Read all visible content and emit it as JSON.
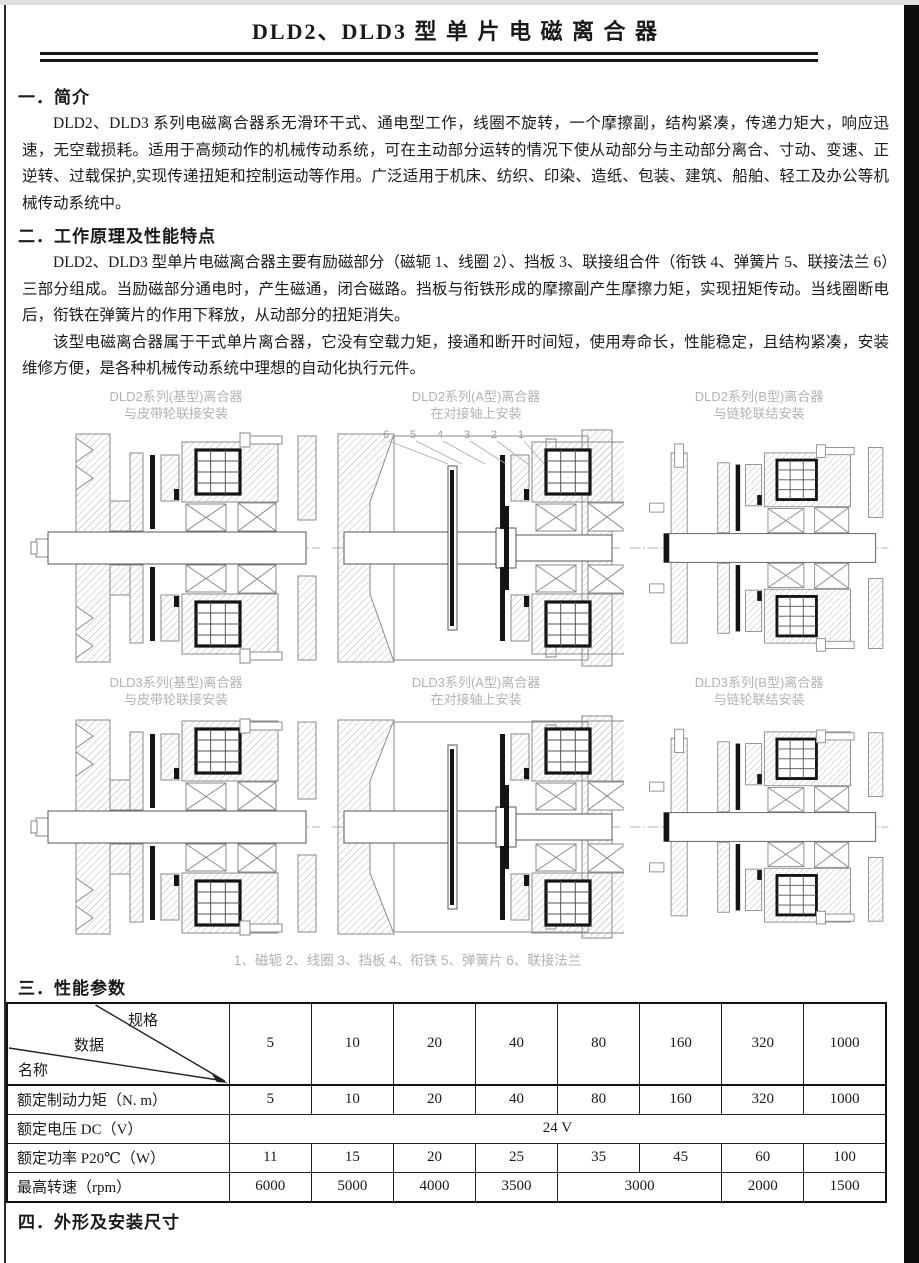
{
  "page": {
    "title": "DLD2、DLD3 型  单 片 电 磁 离 合 器",
    "ink_color": "#1a1a1a",
    "caption_color": "#b0b0b0"
  },
  "section1": {
    "heading": "一．简介",
    "para": "DLD2、DLD3 系列电磁离合器系无滑环干式、通电型工作，线圈不旋转，一个摩擦副，结构紧凑，传递力矩大，响应迅速，无空载损耗。适用于高频动作的机械传动系统，可在主动部分运转的情况下使从动部分与主动部分离合、寸动、变速、正逆转、过载保护,实现传递扭矩和控制运动等作用。广泛适用于机床、纺织、印染、造纸、包装、建筑、船舶、轻工及办公等机械传动系统中。"
  },
  "section2": {
    "heading": "二．工作原理及性能特点",
    "para1": "DLD2、DLD3 型单片电磁离合器主要有励磁部分（磁轭 1、线圈 2）、挡板 3、联接组合件（衔铁 4、弹簧片 5、联接法兰 6）三部分组成。当励磁部分通电时，产生磁通，闭合磁路。挡板与衔铁形成的摩擦副产生摩擦力矩，实现扭矩传动。当线圈断电后，衔铁在弹簧片的作用下释放，从动部分的扭矩消失。",
    "para2": "该型电磁离合器属于干式单片离合器，它没有空载力矩，接通和断开时间短，使用寿命长，性能稳定，且结构紧凑，安装维修方便，是各种机械传动系统中理想的自动化执行元件。"
  },
  "diagrams": {
    "items": [
      {
        "line1": "DLD2系列(基型)离合器",
        "line2": "与皮带轮联接安装",
        "variant": "pulley"
      },
      {
        "line1": "DLD2系列(A型)离合器",
        "line2": "在对接轴上安装",
        "variant": "shaft",
        "part_numbers": [
          "6",
          "5",
          "4",
          "3",
          "2",
          "1"
        ]
      },
      {
        "line1": "DLD2系列(B型)离合器",
        "line2": "与链轮联结安装",
        "variant": "sprocket"
      },
      {
        "line1": "DLD3系列(基型)离合器",
        "line2": "与皮带轮联接安装",
        "variant": "pulley"
      },
      {
        "line1": "DLD3系列(A型)离合器",
        "line2": "在对接轴上安装",
        "variant": "shaft"
      },
      {
        "line1": "DLD3系列(B型)离合器",
        "line2": "与链轮联结安装",
        "variant": "sprocket"
      }
    ],
    "legend": "1、磁轭  2、线圈  3、挡板  4、衔铁  5、弹簧片  6、联接法兰"
  },
  "section3": {
    "heading": "三．性能参数",
    "table": {
      "corner": {
        "top": "规格",
        "middle": "数据",
        "bottom": "名称"
      },
      "spec_columns": [
        "5",
        "10",
        "20",
        "40",
        "80",
        "160",
        "320",
        "1000"
      ],
      "rows": [
        {
          "label": "额定制动力矩（N. m）",
          "values": [
            "5",
            "10",
            "20",
            "40",
            "80",
            "160",
            "320",
            "1000"
          ]
        },
        {
          "label": "额定电压 DC（V）",
          "span_value": "24 V"
        },
        {
          "label": "额定功率 P20℃（W）",
          "values": [
            "11",
            "15",
            "20",
            "25",
            "35",
            "45",
            "60",
            "100"
          ]
        },
        {
          "label": "最高转速（rpm）",
          "values": [
            "6000",
            "5000",
            "4000",
            "3500",
            "3000",
            "2000",
            "1500"
          ],
          "note": "value 3000 spans the 80 and 160 spec columns"
        }
      ]
    }
  },
  "section4": {
    "heading": "四．外形及安装尺寸"
  }
}
